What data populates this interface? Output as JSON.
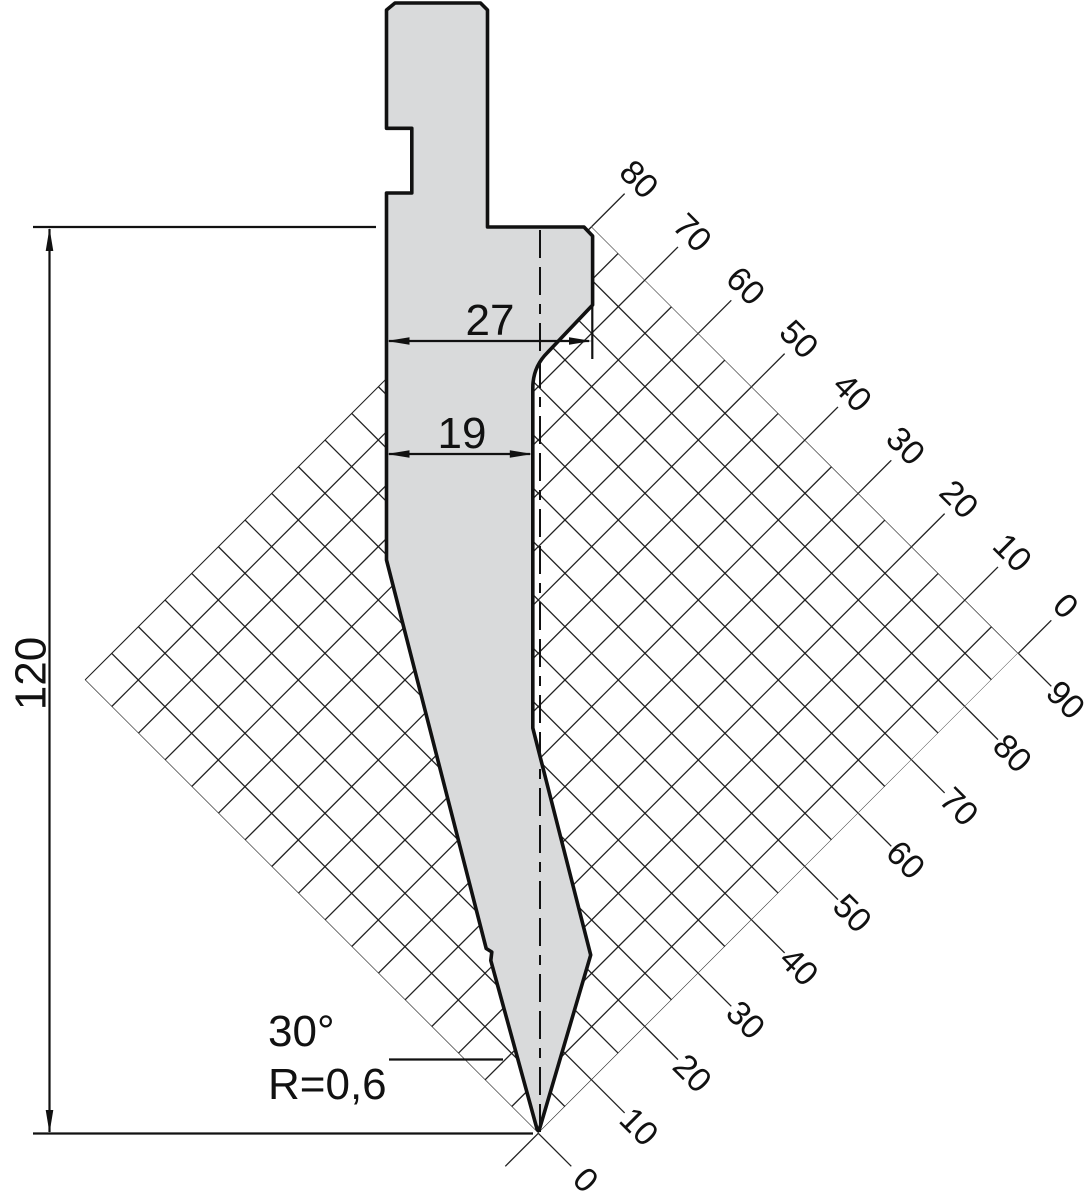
{
  "drawing": {
    "type": "press-brake-punch technical drawing",
    "dimensions": {
      "height": "120",
      "shoulder_width": "27",
      "body_width": "19",
      "tip_angle": "30°",
      "tip_radius": "R=0,6"
    },
    "axes": {
      "top": {
        "labels": [
          "80",
          "70",
          "60",
          "50",
          "40",
          "30",
          "20",
          "10",
          "0"
        ]
      },
      "bottom": {
        "labels": [
          "90",
          "80",
          "70",
          "60",
          "50",
          "40",
          "30",
          "20",
          "10",
          "0"
        ]
      }
    },
    "colors": {
      "part_fill": "#d9dadb",
      "line": "#111111",
      "grid_line": "#222222",
      "background": "#ffffff"
    }
  }
}
